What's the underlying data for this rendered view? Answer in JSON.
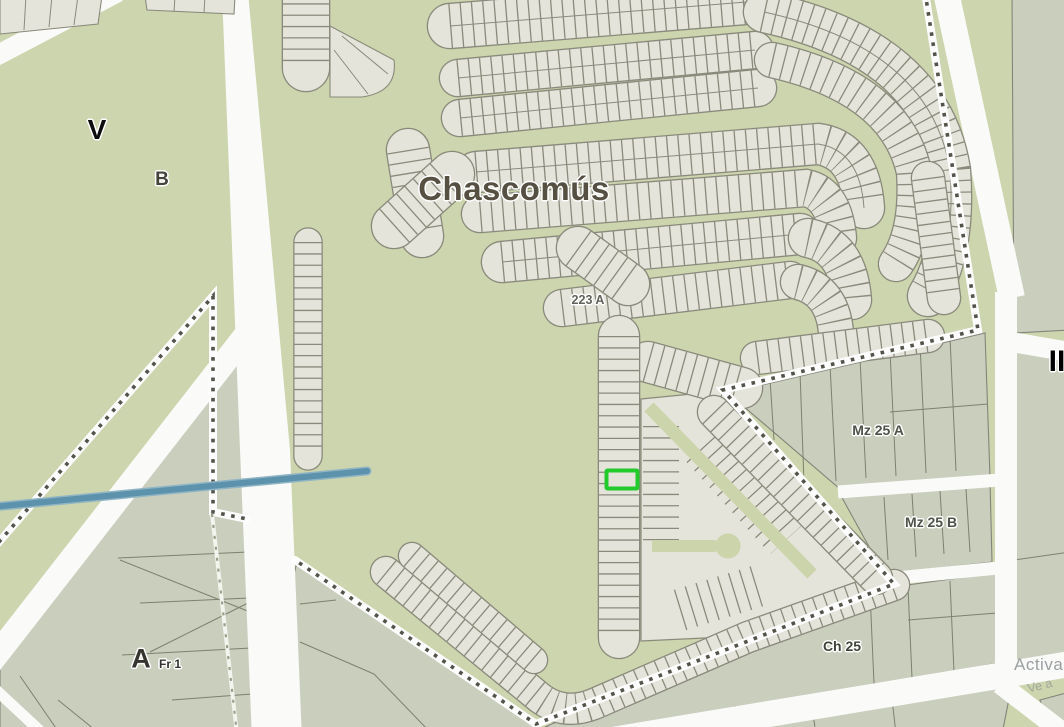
{
  "map": {
    "region_name": "Chascomús",
    "kind": "cadastral-parcel-map",
    "labels": {
      "city": "Chascomús",
      "zone_v": "V",
      "zone_b": "B",
      "parcel_223a": "223 A",
      "mz_25_a": "Mz 25 A",
      "mz_25_b": "Mz 25 B",
      "ch_25": "Ch 25",
      "zone_a": "A",
      "fr_1": "Fr 1",
      "zone_ii": "II"
    },
    "watermark": {
      "line1": "Activa",
      "line2": "Ve a"
    },
    "highlighted_parcel": {
      "present": true,
      "outline_color": "#23ca2b"
    },
    "colors": {
      "background": "#ccd5ad",
      "street_green": "#cbd4ab",
      "parcel_fill": "#e5e4da",
      "parcel_stroke": "#8a8a7c",
      "block_fill": "#c9cebd",
      "block_stroke": "#83857a",
      "road": "#fafaf8",
      "boundary_dot": "#53534a",
      "canal": "#5d92ad",
      "canal_halo": "#8fb4c4",
      "highlight": "#23ca2b",
      "track": "#97a088",
      "label_dark": "#565043",
      "label_black": "#0d0d0d",
      "label_gray": "#4e5449",
      "watermark": "#80858a"
    }
  }
}
